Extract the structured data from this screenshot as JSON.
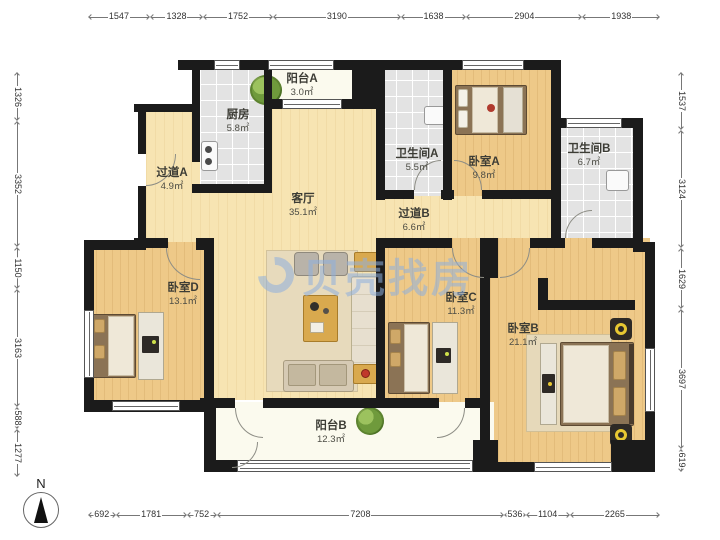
{
  "meta": {
    "compass_label": "N",
    "watermark": "贝壳找房"
  },
  "rulers": {
    "top": [
      "1547",
      "1328",
      "1752",
      "3190",
      "1638",
      "2904",
      "1938"
    ],
    "bottom": [
      "692",
      "1781",
      "752",
      "7208",
      "536",
      "1104",
      "2265"
    ],
    "left": [
      "1326",
      "3352",
      "1150",
      "3163",
      "588",
      "1277"
    ],
    "right": [
      "1537",
      "3124",
      "1629",
      "3697",
      "619"
    ]
  },
  "rooms": {
    "balcony_a": {
      "name": "阳台A",
      "area": "3.0㎡"
    },
    "kitchen": {
      "name": "厨房",
      "area": "5.8㎡"
    },
    "hall_a": {
      "name": "过道A",
      "area": "4.9㎡"
    },
    "living": {
      "name": "客厅",
      "area": "35.1㎡"
    },
    "bath_a": {
      "name": "卫生间A",
      "area": "5.5㎡"
    },
    "bed_a": {
      "name": "卧室A",
      "area": "9.8㎡"
    },
    "bath_b": {
      "name": "卫生间B",
      "area": "6.7㎡"
    },
    "hall_b": {
      "name": "过道B",
      "area": "6.6㎡"
    },
    "bed_d": {
      "name": "卧室D",
      "area": "13.1㎡"
    },
    "bed_c": {
      "name": "卧室C",
      "area": "11.3㎡"
    },
    "bed_b": {
      "name": "卧室B",
      "area": "21.1㎡"
    },
    "balcony_b": {
      "name": "阳台B",
      "area": "12.3㎡"
    }
  },
  "colors": {
    "wall": "#1b1b1b",
    "wood": "#eec988",
    "tile": "#e3e3e3",
    "balcony": "#fbfaee",
    "watermark": "#8fb0de"
  }
}
